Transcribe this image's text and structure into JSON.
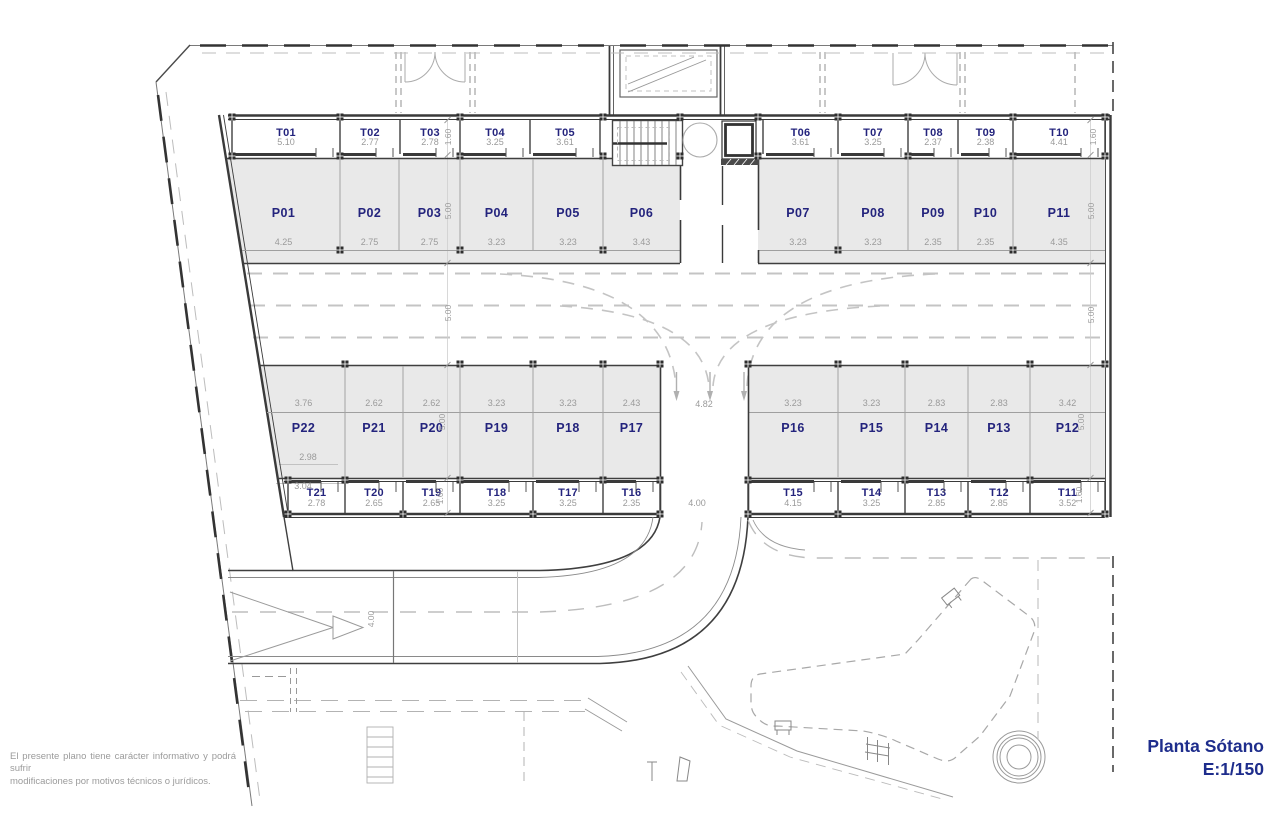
{
  "title_block": {
    "plan_name": "Planta Sótano",
    "scale": "E:1/150"
  },
  "disclaimer": {
    "line1": "El presente plano tiene carácter informativo y podrá sufrir",
    "line2": "modificaciones por motivos técnicos o jurídicos."
  },
  "colors": {
    "unit_label": "#24247d",
    "dimension_text": "#9a9a9a",
    "wall": "#3f3f3f",
    "stall_fill": "#e9e9e9",
    "light_line": "#c4c4c4"
  },
  "plan": {
    "rows": [
      {
        "name": "storage-top",
        "kind": "storage",
        "label_y": 136,
        "dim_y": 145,
        "div": [
          120,
          154
        ],
        "front_y": 154.5,
        "tick": [
          148,
          157
        ],
        "cells": [
          {
            "label": "T01",
            "dim": "5.10",
            "x0": 232,
            "x1": 340
          },
          {
            "label": "T02",
            "dim": "2.77",
            "x0": 340,
            "x1": 400
          },
          {
            "label": "T03",
            "dim": "2.78",
            "x0": 400,
            "x1": 460
          },
          {
            "label": "T04",
            "dim": "3.25",
            "x0": 460,
            "x1": 530
          },
          {
            "label": "T05",
            "dim": "3.61",
            "x0": 530,
            "x1": 600
          },
          {
            "label": "T06",
            "dim": "3.61",
            "x0": 763,
            "x1": 838
          },
          {
            "label": "T07",
            "dim": "3.25",
            "x0": 838,
            "x1": 908
          },
          {
            "label": "T08",
            "dim": "2.37",
            "x0": 908,
            "x1": 958
          },
          {
            "label": "T09",
            "dim": "2.38",
            "x0": 958,
            "x1": 1013
          },
          {
            "label": "T10",
            "dim": "4.41",
            "x0": 1013,
            "x1": 1105
          }
        ]
      },
      {
        "name": "parking-top",
        "kind": "parking",
        "label_y": 217,
        "dim_y": 245,
        "div": [
          159,
          250
        ],
        "cells": [
          {
            "label": "P01",
            "dim": "4.25",
            "x0": 227,
            "x1": 340
          },
          {
            "label": "P02",
            "dim": "2.75",
            "x0": 340,
            "x1": 399
          },
          {
            "label": "P03",
            "dim": "2.75",
            "x0": 399,
            "x1": 460
          },
          {
            "label": "P04",
            "dim": "3.23",
            "x0": 460,
            "x1": 533
          },
          {
            "label": "P05",
            "dim": "3.23",
            "x0": 533,
            "x1": 603
          },
          {
            "label": "P06",
            "dim": "3.43",
            "x0": 603,
            "x1": 680
          },
          {
            "label": "P07",
            "dim": "3.23",
            "x0": 758,
            "x1": 838
          },
          {
            "label": "P08",
            "dim": "3.23",
            "x0": 838,
            "x1": 908
          },
          {
            "label": "P09",
            "dim": "2.35",
            "x0": 908,
            "x1": 958
          },
          {
            "label": "P10",
            "dim": "2.35",
            "x0": 958,
            "x1": 1013
          },
          {
            "label": "P11",
            "dim": "4.35",
            "x0": 1013,
            "x1": 1105
          }
        ]
      },
      {
        "name": "parking-bottom",
        "kind": "parking",
        "label_y": 432,
        "dim_y": 406,
        "div": [
          366,
          477
        ],
        "cells": [
          {
            "label": "P22",
            "dim": "3.76",
            "x0": 262,
            "x1": 345
          },
          {
            "label": "P21",
            "dim": "2.62",
            "x0": 345,
            "x1": 403
          },
          {
            "label": "P20",
            "dim": "2.62",
            "x0": 403,
            "x1": 460
          },
          {
            "label": "P19",
            "dim": "3.23",
            "x0": 460,
            "x1": 533
          },
          {
            "label": "P18",
            "dim": "3.23",
            "x0": 533,
            "x1": 603
          },
          {
            "label": "P17",
            "dim": "2.43",
            "x0": 603,
            "x1": 660
          },
          {
            "label": "P16",
            "dim": "3.23",
            "x0": 748,
            "x1": 838
          },
          {
            "label": "P15",
            "dim": "3.23",
            "x0": 838,
            "x1": 905
          },
          {
            "label": "P14",
            "dim": "2.83",
            "x0": 905,
            "x1": 968
          },
          {
            "label": "P13",
            "dim": "2.83",
            "x0": 968,
            "x1": 1030
          },
          {
            "label": "P12",
            "dim": "3.42",
            "x0": 1030,
            "x1": 1105
          }
        ]
      },
      {
        "name": "storage-bottom",
        "kind": "storage",
        "label_y": 496,
        "dim_y": 506,
        "div": [
          482,
          513
        ],
        "front_y": 481.5,
        "tick": [
          482,
          492
        ],
        "cells": [
          {
            "label": "T21",
            "dim": "2.78",
            "x0": 288,
            "x1": 345
          },
          {
            "label": "T20",
            "dim": "2.65",
            "x0": 345,
            "x1": 403
          },
          {
            "label": "T19",
            "dim": "2.65",
            "x0": 403,
            "x1": 460
          },
          {
            "label": "T18",
            "dim": "3.25",
            "x0": 460,
            "x1": 533
          },
          {
            "label": "T17",
            "dim": "3.25",
            "x0": 533,
            "x1": 603
          },
          {
            "label": "T16",
            "dim": "2.35",
            "x0": 603,
            "x1": 660
          },
          {
            "label": "T15",
            "dim": "4.15",
            "x0": 748,
            "x1": 838
          },
          {
            "label": "T14",
            "dim": "3.25",
            "x0": 838,
            "x1": 905
          },
          {
            "label": "T13",
            "dim": "2.85",
            "x0": 905,
            "x1": 968
          },
          {
            "label": "T12",
            "dim": "2.85",
            "x0": 968,
            "x1": 1030
          },
          {
            "label": "T11",
            "dim": "3.52",
            "x0": 1030,
            "x1": 1105
          }
        ]
      }
    ],
    "vertical_dims": [
      {
        "x": 451,
        "y": 137,
        "t": "1.60"
      },
      {
        "x": 451,
        "y": 211,
        "t": "5.00"
      },
      {
        "x": 451,
        "y": 313,
        "t": "5.00"
      },
      {
        "x": 445,
        "y": 422,
        "t": "5.00"
      },
      {
        "x": 443,
        "y": 496,
        "t": "1.60"
      },
      {
        "x": 1096,
        "y": 137,
        "t": "1.60"
      },
      {
        "x": 1094,
        "y": 211,
        "t": "5.00"
      },
      {
        "x": 1094,
        "y": 315,
        "t": "5.00"
      },
      {
        "x": 1084,
        "y": 422,
        "t": "5.00"
      },
      {
        "x": 1082,
        "y": 495,
        "t": "1.60"
      },
      {
        "x": 374,
        "y": 619,
        "t": "4.00"
      }
    ],
    "loose_dims": [
      {
        "x": 704,
        "y": 407,
        "t": "4.82"
      },
      {
        "x": 697,
        "y": 506,
        "t": "4.00"
      },
      {
        "x": 308,
        "y": 460,
        "t": "2.98"
      },
      {
        "x": 303,
        "y": 489,
        "t": "3.04"
      }
    ],
    "columns": [
      [
        232,
        117
      ],
      [
        340,
        117
      ],
      [
        460,
        117
      ],
      [
        603,
        117
      ],
      [
        680,
        117
      ],
      [
        758,
        117
      ],
      [
        838,
        117
      ],
      [
        908,
        117
      ],
      [
        1013,
        117
      ],
      [
        1105,
        117
      ],
      [
        232,
        156
      ],
      [
        340,
        156
      ],
      [
        460,
        156
      ],
      [
        603,
        156
      ],
      [
        680,
        156
      ],
      [
        758,
        156
      ],
      [
        908,
        156
      ],
      [
        1013,
        156
      ],
      [
        1105,
        156
      ],
      [
        340,
        250
      ],
      [
        460,
        250
      ],
      [
        603,
        250
      ],
      [
        838,
        250
      ],
      [
        1013,
        250
      ],
      [
        345,
        364
      ],
      [
        460,
        364
      ],
      [
        533,
        364
      ],
      [
        603,
        364
      ],
      [
        660,
        364
      ],
      [
        748,
        364
      ],
      [
        838,
        364
      ],
      [
        905,
        364
      ],
      [
        1030,
        364
      ],
      [
        1105,
        364
      ],
      [
        288,
        480
      ],
      [
        345,
        480
      ],
      [
        460,
        480
      ],
      [
        603,
        480
      ],
      [
        660,
        480
      ],
      [
        748,
        480
      ],
      [
        905,
        480
      ],
      [
        1030,
        480
      ],
      [
        288,
        514
      ],
      [
        403,
        514
      ],
      [
        533,
        514
      ],
      [
        660,
        514
      ],
      [
        748,
        514
      ],
      [
        838,
        514
      ],
      [
        968,
        514
      ],
      [
        1105,
        514
      ]
    ],
    "tick_lines": {
      "xs": [
        447.5,
        1090.5
      ],
      "ys": [
        120,
        155,
        263,
        365,
        478,
        513
      ]
    }
  }
}
